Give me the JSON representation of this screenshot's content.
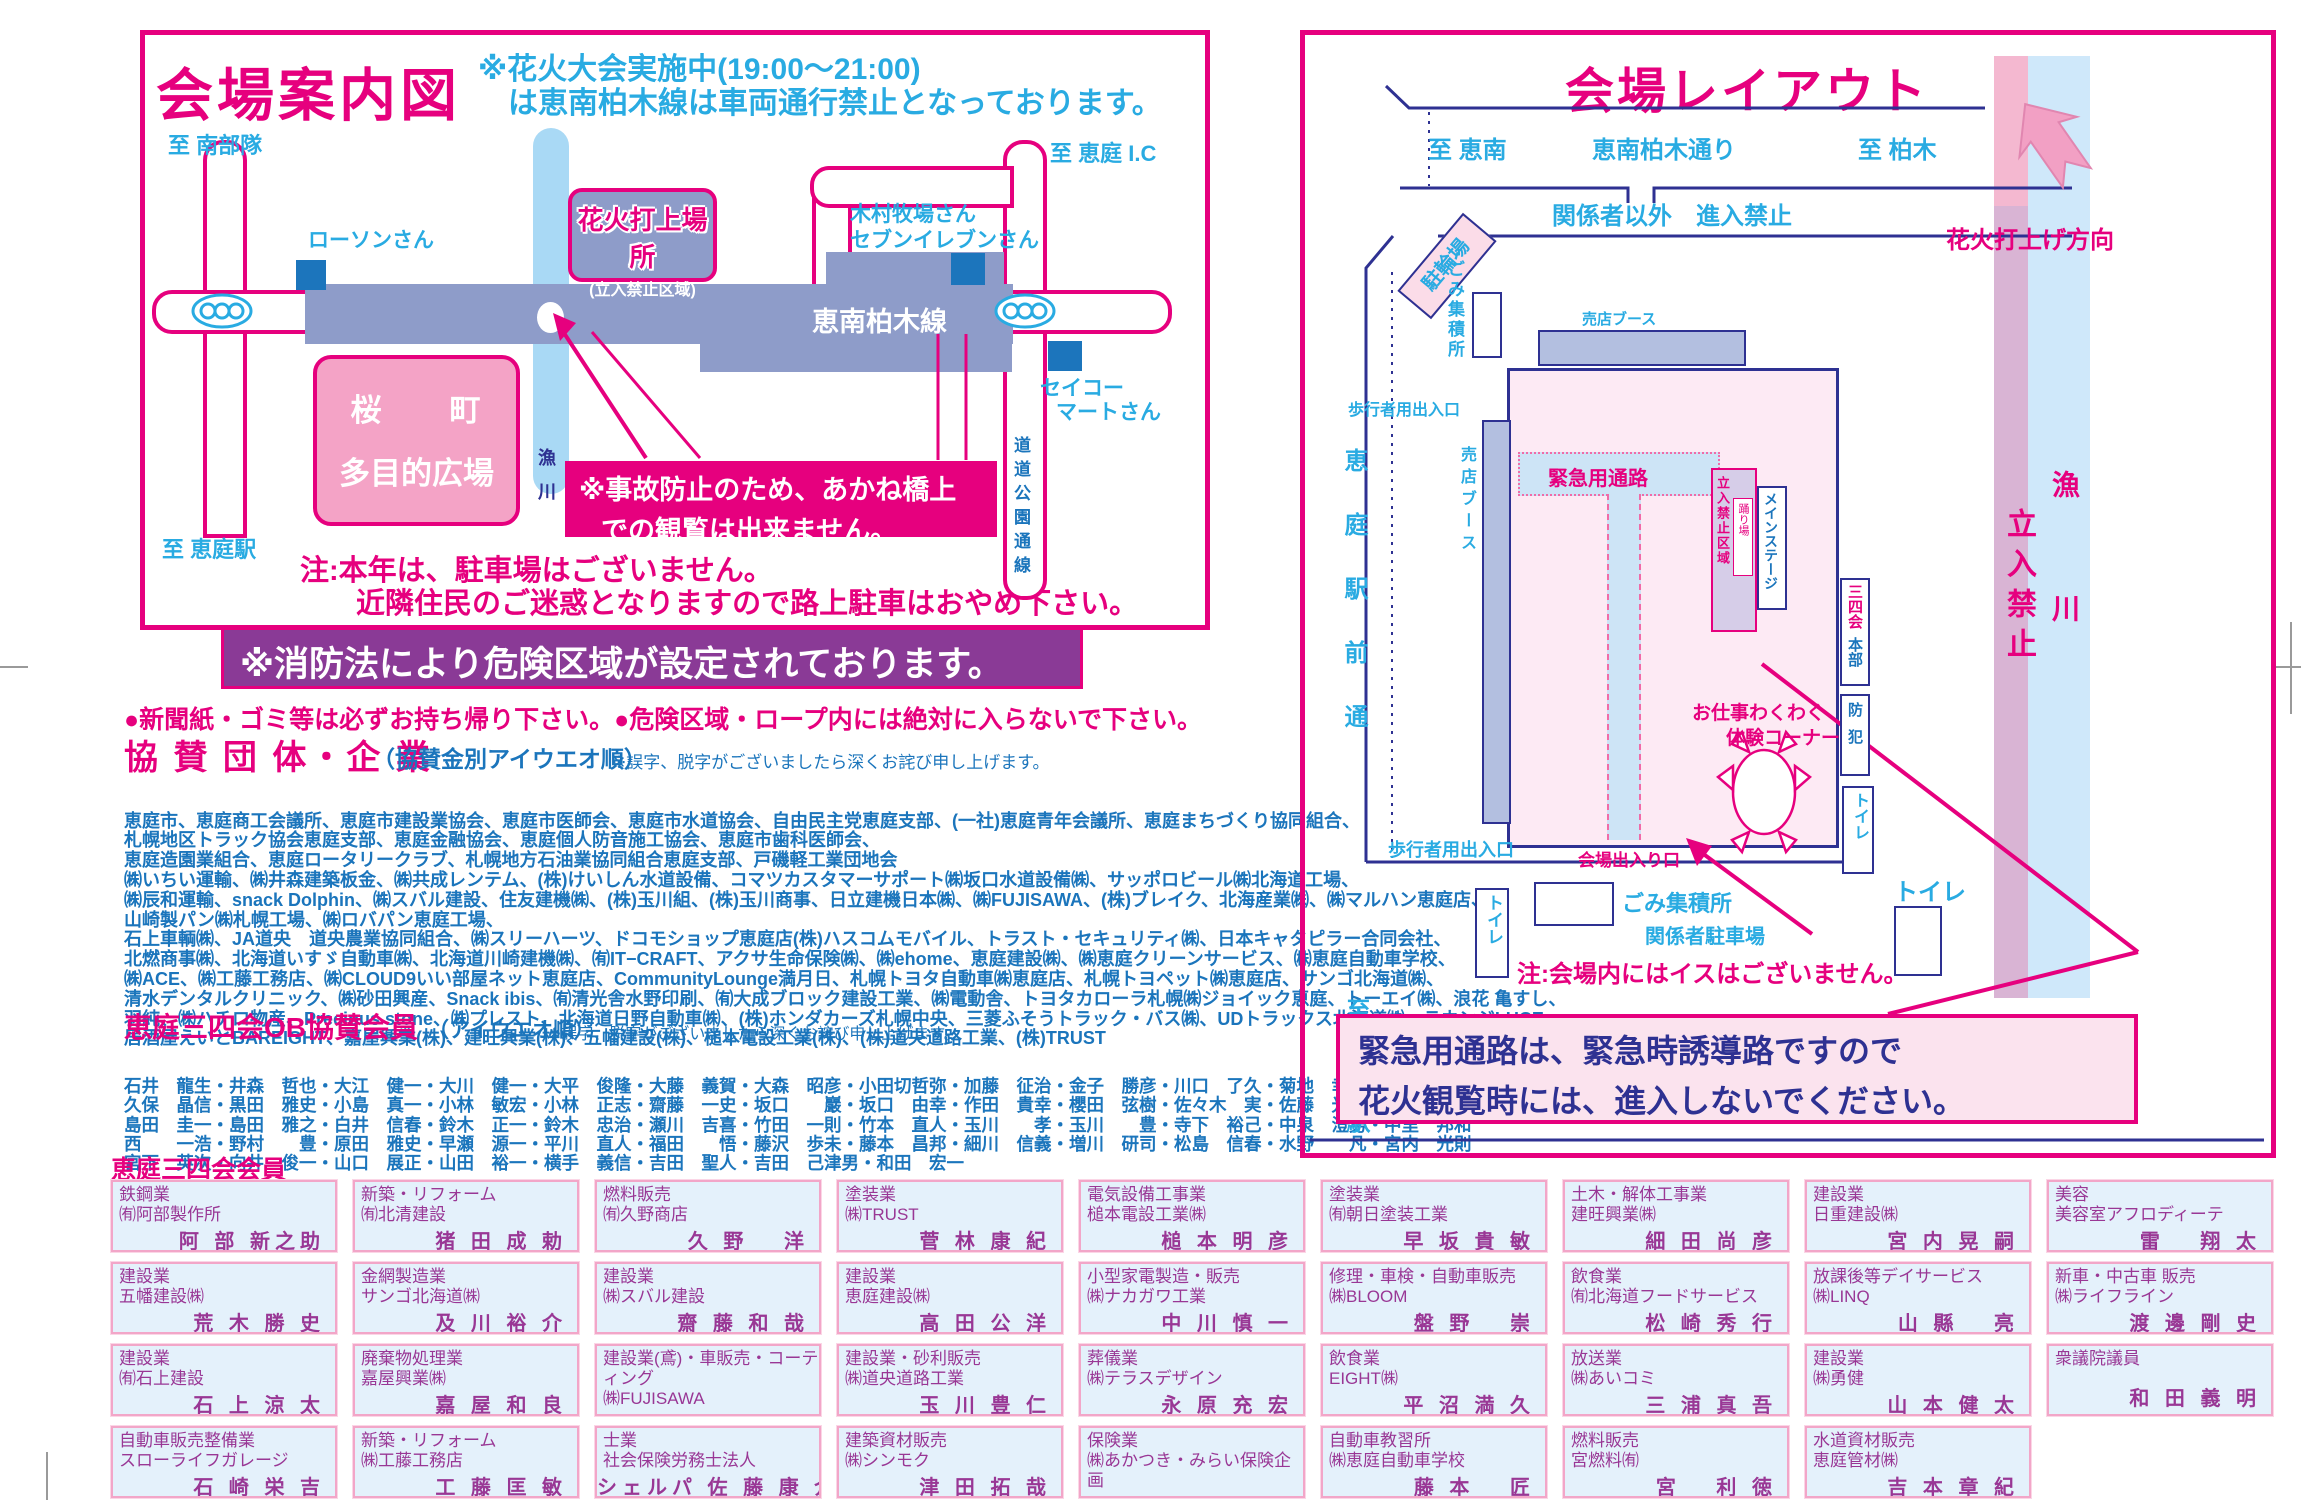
{
  "colors": {
    "magenta": "#e6007e",
    "navy": "#2e3192",
    "light_blue": "#29abe2",
    "list_blue": "#1b75bc",
    "slate_road": "#8e9cc9",
    "river_blue": "#a9d9f5",
    "banner_purple": "#8a3a96",
    "member_box_bg": "#e4f1fb",
    "member_box_border": "#f2a6c8",
    "member_text": "#993795"
  },
  "left_panel": {
    "title": "会場案内図",
    "notice_line1": "※花火大会実施中(19:00〜21:00)",
    "notice_line2": "は恵南柏木線は車両通行禁止となっております。",
    "map": {
      "to_nanbutai": "至 南部隊",
      "to_eniwa_ic": "至 恵庭 I.C",
      "to_eniwa_station": "至 恵庭駅",
      "lawson": "ローソンさん",
      "kimura_farm": "木村牧場さん",
      "seven_eleven": "セブンイレブンさん",
      "seicomart_line1": "セイコー",
      "seicomart_line2": "マートさん",
      "launch_site": "花火打上場所",
      "launch_site_sub": "(立入禁止区域)",
      "keinan_kashiwagi_line": "恵南柏木線",
      "river": "漁川",
      "river_char1": "漁",
      "river_char2": "川",
      "prefectural_road": "道道公園通線",
      "plaza_line1": "桜　　町",
      "plaza_line2": "多目的広場",
      "accident_line1": "※事故防止のため、あかね橋上",
      "accident_line2": "での観覧は出来ません。"
    },
    "parking_note_line1": "注:本年は、駐車場はございません。",
    "parking_note_line2": "近隣住民のご迷惑となりますので路上駐車はおやめ下さい。"
  },
  "fire_banner": "※消防法により危険区域が設定されております。",
  "bullets": "●新聞紙・ゴミ等は必ずお持ち帰り下さい。●危険区域・ロープ内には絶対に入らないで下さい。",
  "sponsors": {
    "heading": "協 賛 団 体・企 業",
    "sub1": "（協賛金別アイウエオ順）",
    "sub2": "※誤字、脱字がございましたら深くお詫び申し上げます。",
    "lines": [
      "恵庭市、恵庭商工会議所、恵庭市建設業協会、恵庭市医師会、恵庭市水道協会、自由民主党恵庭支部、(一社)恵庭青年会議所、恵庭まちづくり協同組合、",
      "札幌地区トラック協会恵庭支部、恵庭金融協会、恵庭個人防音施工協会、恵庭市歯科医師会、",
      "恵庭造園業組合、恵庭ロータリークラブ、札幌地方石油業協同組合恵庭支部、戸磯軽工業団地会",
      "㈱いちい運輸、㈱井森建築板金、㈱共成レンテム、(株)けいしん水道設備、コマツカスタマーサポート㈱坂口水道設備㈱、サッポロビール㈱北海道工場、",
      "㈱辰和運輸、snack Dolphin、㈱スバル建設、住友建機㈱、(株)玉川組、(株)玉川商事、日立建機日本㈱、㈱FUJISAWA、(株)ブレイク、北海産業㈱、㈱マルハン恵庭店、",
      "山崎製パン㈱札幌工場、㈱ロバパン恵庭工場、",
      "石上車輌㈱、JA道央　道央農業協同組合、㈱スリーハーツ、ドコモショップ恵庭店(株)ハスコムモバイル、トラスト・セキュリティ㈱、日本キャタピラー合同会社、",
      "北燃商事㈱、北海道いすゞ自動車㈱、北海道川崎建機㈱、㈲IT−CRAFT、アクサ生命保険㈱、㈱ehome、恵庭建設㈱、㈱恵庭クリーンサービス、㈱恵庭自動車学校、",
      "㈱ACE、㈱工藤工務店、㈱CLOUD9いい部屋ネット恵庭店、CommunityLounge満月日、札幌トヨタ自動車㈱恵庭店、札幌トヨペット㈱恵庭店、サンゴ北海道㈱、",
      "清水デンタルクリニック、㈱砂田興産、Snack ibis、㈲清光舎水野印刷、㈲大成ブロック建設工業、㈱電動舎、トヨタカローラ札幌㈱ジョイック恵庭、トーエイ㈱、浪花 亀すし、",
      "羽純、㈱ハチロ物産、Precious stone、㈱プレスト、北海道日野自動車㈱、(株)ホンダカーズ札幌中央、三菱ふそうトラック・バス㈱、UDトラックス北海道㈱、ラウンジLUCE、",
      "居酒屋えいとBAREIGHT、嘉屋興業(株)、建旺興業(株)、五幡建設(株)、槌本電設工業(株)、(株)道央道路工業、(株)TRUST"
    ]
  },
  "ob_members": {
    "heading": "恵庭三四会OB協賛会員",
    "sub1": "（アイウエオ順）",
    "sub2": "※誤字、脱字がございましたら深くお詫び申し上げます。",
    "rows": [
      "石井　龍生・井森　哲也・大江　健一・大川　健一・大平　俊隆・大藤　義賀・大森　昭彦・小田切哲弥・加藤　征治・金子　勝彦・川口　了久・菊地　幸博・久野　　収",
      "久保　晶信・黒田　雅史・小島　真一・小林　敏宏・小林　正志・齋藤　一史・坂口　　巖・坂口　由幸・作田　貴幸・櫻田　弦樹・佐々木　実・佐藤　光和・柴田　純一",
      "島田　圭一・島田　雅之・白井　信春・鈴木　正一・鈴木　忠治・瀬川　吉喜・竹田　一則・竹本　直人・玉川　　孝・玉川　　豊・寺下　裕己・中泉　澄男・中里　邦和",
      "西　　一浩・野村　　豊・原田　雅史・早瀬　源一・平川　直人・福田　　悟・藤沢　歩未・藤本　昌邦・細川　信義・増川　研司・松島　信春・水野　　凡・宮内　光則",
      "宮下　英次・向井　俊一・山口　展正・山田　裕一・横手　義信・吉田　聖人・吉田　己津男・和田　宏一"
    ]
  },
  "members": {
    "heading": "恵庭三四会会員",
    "boxes": [
      {
        "category": "鉄鋼業",
        "company": "㈲阿部製作所",
        "name": "阿 部 新之助"
      },
      {
        "category": "新築・リフォーム",
        "company": "㈲北清建設",
        "name": "猪 田 成 勅"
      },
      {
        "category": "燃料販売",
        "company": "㈲久野商店",
        "name": "久 野　 洋"
      },
      {
        "category": "塗装業",
        "company": "㈱TRUST",
        "name": "菅 林 康 紀"
      },
      {
        "category": "電気設備工事業",
        "company": "槌本電設工業㈱",
        "name": "槌 本 明 彦"
      },
      {
        "category": "塗装業",
        "company": "㈲朝日塗装工業",
        "name": "早 坂 貴 敏"
      },
      {
        "category": "土木・解体工事業",
        "company": "建旺興業㈱",
        "name": "細 田 尚 彦"
      },
      {
        "category": "建設業",
        "company": "日重建設㈱",
        "name": "宮 内 晃 嗣"
      },
      {
        "category": "美容",
        "company": "美容室アフロディーテ",
        "name": "雷　 翔 太"
      },
      {
        "category": "建設業",
        "company": "五幡建設㈱",
        "name": "荒 木 勝 史"
      },
      {
        "category": "金網製造業",
        "company": "サンゴ北海道㈱",
        "name": "及 川 裕 介"
      },
      {
        "category": "建設業",
        "company": "㈱スバル建設",
        "name": "齋 藤 和 哉"
      },
      {
        "category": "建設業",
        "company": "恵庭建設㈱",
        "name": "高 田 公 洋"
      },
      {
        "category": "小型家電製造・販売",
        "company": "㈱ナカガワ工業",
        "name": "中 川 慎 一"
      },
      {
        "category": "修理・車検・自動車販売",
        "company": "㈱BLOOM",
        "name": "盤 野　 崇"
      },
      {
        "category": "飲食業",
        "company": "㈲北海道フードサービス",
        "name": "松 崎 秀 行"
      },
      {
        "category": "放課後等デイサービス",
        "company": "㈱LINQ",
        "name": "山 縣　 亮"
      },
      {
        "category": "新車・中古車 販売",
        "company": "㈱ライフライン",
        "name": "渡 邊 剛 史"
      },
      {
        "category": "建設業",
        "company": "㈲石上建設",
        "name": "石 上 涼 太"
      },
      {
        "category": "廃棄物処理業",
        "company": "嘉屋興業㈱",
        "name": "嘉 屋 和 良"
      },
      {
        "category": "建設業(鳶)・車販売・コーティング",
        "company": "㈱FUJISAWA",
        "name": "相 良 比呂樹"
      },
      {
        "category": "建設業・砂利販売",
        "company": "㈱道央道路工業",
        "name": "玉 川 豊 仁"
      },
      {
        "category": "葬儀業",
        "company": "㈱テラスデザイン",
        "name": "永 原 充 宏"
      },
      {
        "category": "飲食業",
        "company": "EIGHT㈱",
        "name": "平 沼 満 久"
      },
      {
        "category": "放送業",
        "company": "㈱あいコミ",
        "name": "三 浦 真 吾"
      },
      {
        "category": "建設業",
        "company": "㈱勇健",
        "name": "山 本 健 太"
      },
      {
        "category": "衆議院議員",
        "company": "",
        "name": "和 田 義 明"
      },
      {
        "category": "自動車販売整備業",
        "company": "スローライフガレージ",
        "name": "石 崎 栄 吉"
      },
      {
        "category": "新築・リフォーム",
        "company": "㈱工藤工務店",
        "name": "工 藤 匡 敏"
      },
      {
        "category": "士業",
        "company": "社会保険労務士法人",
        "name": "シェルパ 佐 藤 康 介"
      },
      {
        "category": "建築資材販売",
        "company": "㈱シンモク",
        "name": "津 田 拓 哉"
      },
      {
        "category": "保険業",
        "company": "㈱あかつき・みらい保険企画",
        "name": "長 谷 部 洋 介"
      },
      {
        "category": "自動車教習所",
        "company": "㈱恵庭自動車学校",
        "name": "藤 本　 匠"
      },
      {
        "category": "燃料販売",
        "company": "宮燃料㈲",
        "name": "宮　 利 徳"
      },
      {
        "category": "水道資材販売",
        "company": "恵庭管材㈱",
        "name": "吉 本 章 紀"
      }
    ]
  },
  "right_panel": {
    "title": "会場レイアウト",
    "to_keinan": "至 恵南",
    "street_top": "恵南柏木通り",
    "to_kashiwagi": "至 柏木",
    "launch_direction": "花火打上げ方向",
    "no_entry_staff": "関係者以外　進入禁止",
    "bicycle_parking": "駐輪場",
    "trash_top": "ごみ集積所",
    "pedestrian_gate_top": "歩行者用出入口",
    "booth_top": "売店ブース",
    "booth_left": "売店ブース",
    "street_left": "恵庭駅前通",
    "to_eniwa_station": "至 恵庭駅",
    "emergency_corridor": "緊急用通路",
    "stage_restricted": "立入禁止区域",
    "odoriba": "踊り場",
    "main_stage": "メインステージ",
    "honbu_34kai": "三四会",
    "honbu": "本部",
    "bohan": "防犯",
    "toilet": "トイレ",
    "work_corner_line1": "お仕事わくわく",
    "work_corner_line2": "体験コーナー",
    "venue_gate": "会場出入り口",
    "pedestrian_gate_bottom": "歩行者用出入口",
    "trash_bottom": "ごみ集積所",
    "staff_parking": "関係者駐車場",
    "no_chairs": "注:会場内にはイスはございません。",
    "restricted_band": "立入禁止",
    "river_char1": "漁",
    "river_char2": "川",
    "note_line1": "緊急用通路は、緊急時誘導路ですので",
    "note_line2": "花火観覧時には、進入しないでください。"
  }
}
